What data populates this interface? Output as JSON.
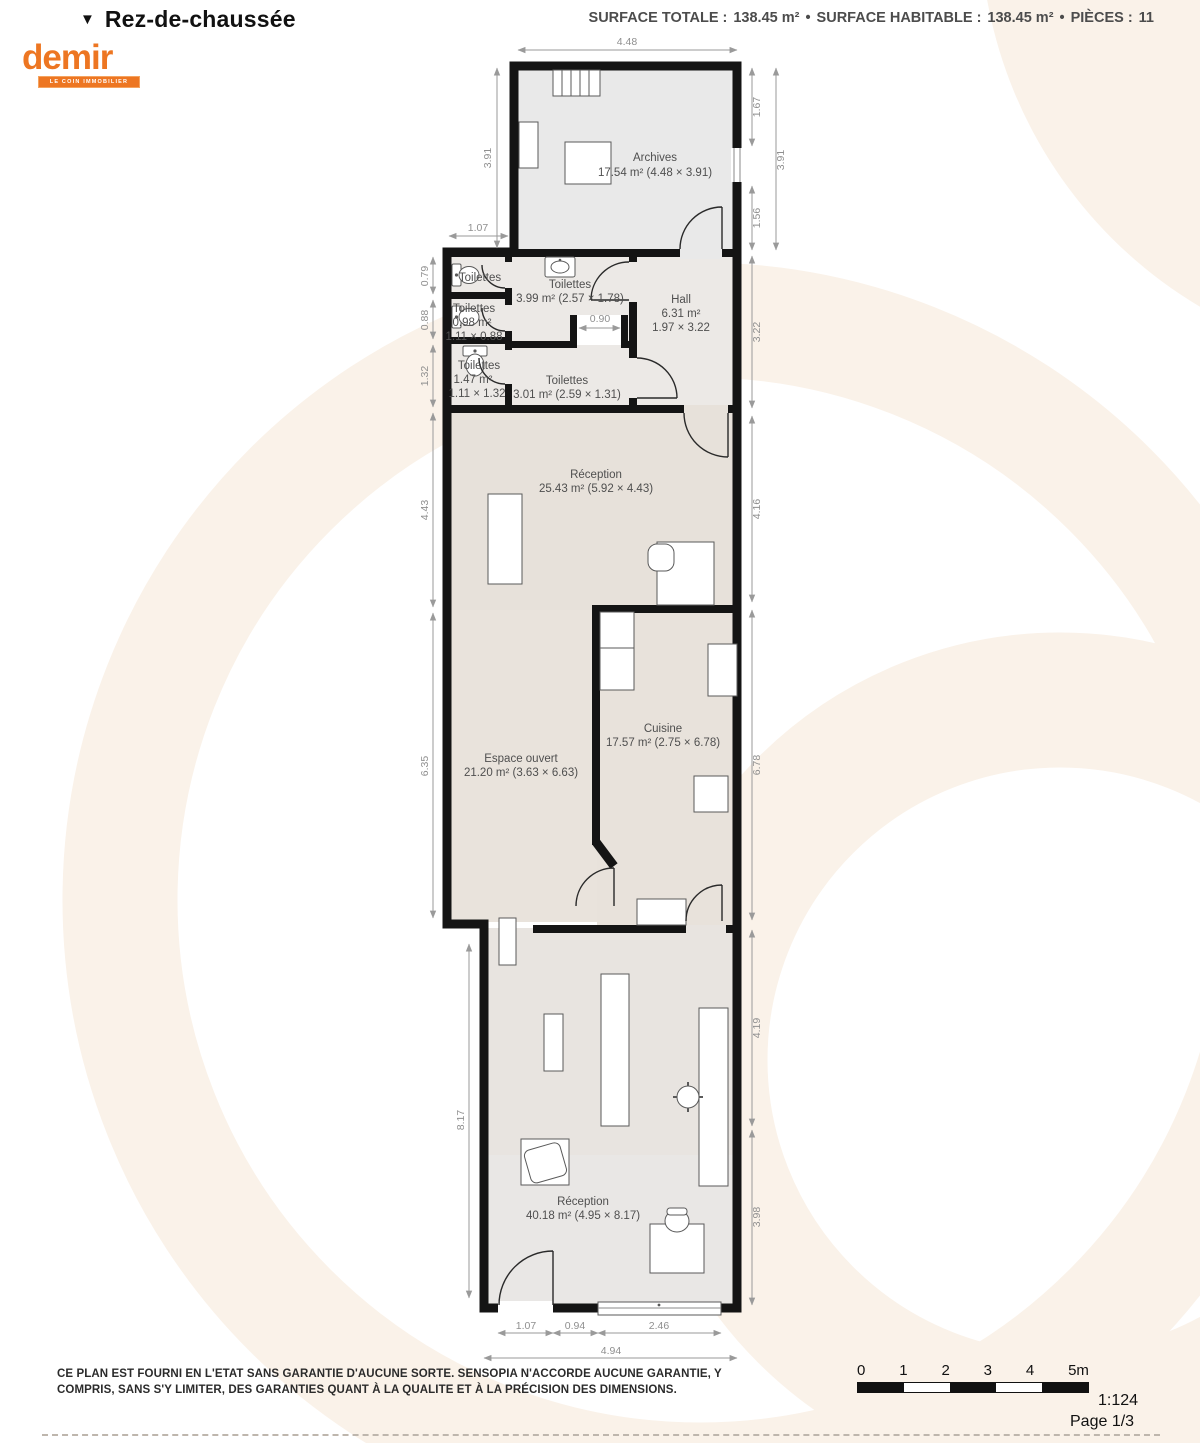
{
  "header": {
    "floor_marker": "▼",
    "floor_title": "Rez-de-chaussée",
    "stats": {
      "surface_totale_label": "SURFACE TOTALE :",
      "surface_totale_value": "138.45 m²",
      "sep1": "•",
      "surface_habitable_label": "SURFACE HABITABLE :",
      "surface_habitable_value": "138.45 m²",
      "sep2": "•",
      "pieces_label": "PIÈCES :",
      "pieces_value": "11"
    }
  },
  "logo": {
    "brand": "demir",
    "tagline": "LE COIN IMMOBILIER"
  },
  "rooms": {
    "archives": {
      "name": "Archives",
      "details": "17.54 m² (4.48 × 3.91)"
    },
    "toilettes_small_1": {
      "name": "Toilettes"
    },
    "toilettes_small_2": {
      "name": "Toilettes",
      "area": "0.98 m²",
      "dims": "1.11 × 0.88"
    },
    "toilettes_small_3": {
      "name": "Toilettes",
      "area": "1.47 m²",
      "dims": "1.11 × 1.32"
    },
    "toilettes_main": {
      "name": "Toilettes",
      "details": "3.99 m² (2.57 × 1.78)"
    },
    "hall": {
      "name": "Hall",
      "area": "6.31 m²",
      "dims": "1.97 × 3.22"
    },
    "toilettes_301": {
      "name": "Toilettes",
      "details": "3.01 m² (2.59 × 1.31)"
    },
    "reception_1": {
      "name": "Réception",
      "details": "25.43 m² (5.92 × 4.43)"
    },
    "espace_ouvert": {
      "name": "Espace ouvert",
      "details": "21.20 m² (3.63 × 6.63)"
    },
    "cuisine": {
      "name": "Cuisine",
      "details": "17.57 m² (2.75 × 6.78)"
    },
    "reception_2": {
      "name": "Réception",
      "details": "40.18 m² (4.95 × 8.17)"
    }
  },
  "dims": {
    "top_448": "4.48",
    "left_391": "3.91",
    "upper_107": "1.07",
    "left_079": "0.79",
    "left_088": "0.88",
    "left_132": "1.32",
    "left_443": "4.43",
    "left_635": "6.35",
    "left_817": "8.17",
    "mid_090": "0.90",
    "right_167": "1.67",
    "right_156": "1.56",
    "right_391": "3.91",
    "right_322": "3.22",
    "right_416": "4.16",
    "right_678": "6.78",
    "right_419": "4.19",
    "right_398": "3.98",
    "bot_107": "1.07",
    "bot_094": "0.94",
    "bot_246": "2.46",
    "bot_494": "4.94"
  },
  "footer": {
    "disclaimer": "CE PLAN EST FOURNI EN L'ETAT SANS GARANTIE D'AUCUNE SORTE. SENSOPIA N'ACCORDE AUCUNE GARANTIE, Y COMPRIS, SANS S'Y LIMITER, DES GARANTIES QUANT À LA QUALITE ET À LA PRÉCISION DES DIMENSIONS.",
    "scale_ticks": {
      "t0": "0",
      "t1": "1",
      "t2": "2",
      "t3": "3",
      "t4": "4",
      "t5": "5m"
    },
    "scale_ratio": "1:124",
    "page": "Page 1/3"
  },
  "colors": {
    "brand_orange": "#ed7622",
    "wall_black": "#141414",
    "watermark_cream": "#faf2e9"
  }
}
